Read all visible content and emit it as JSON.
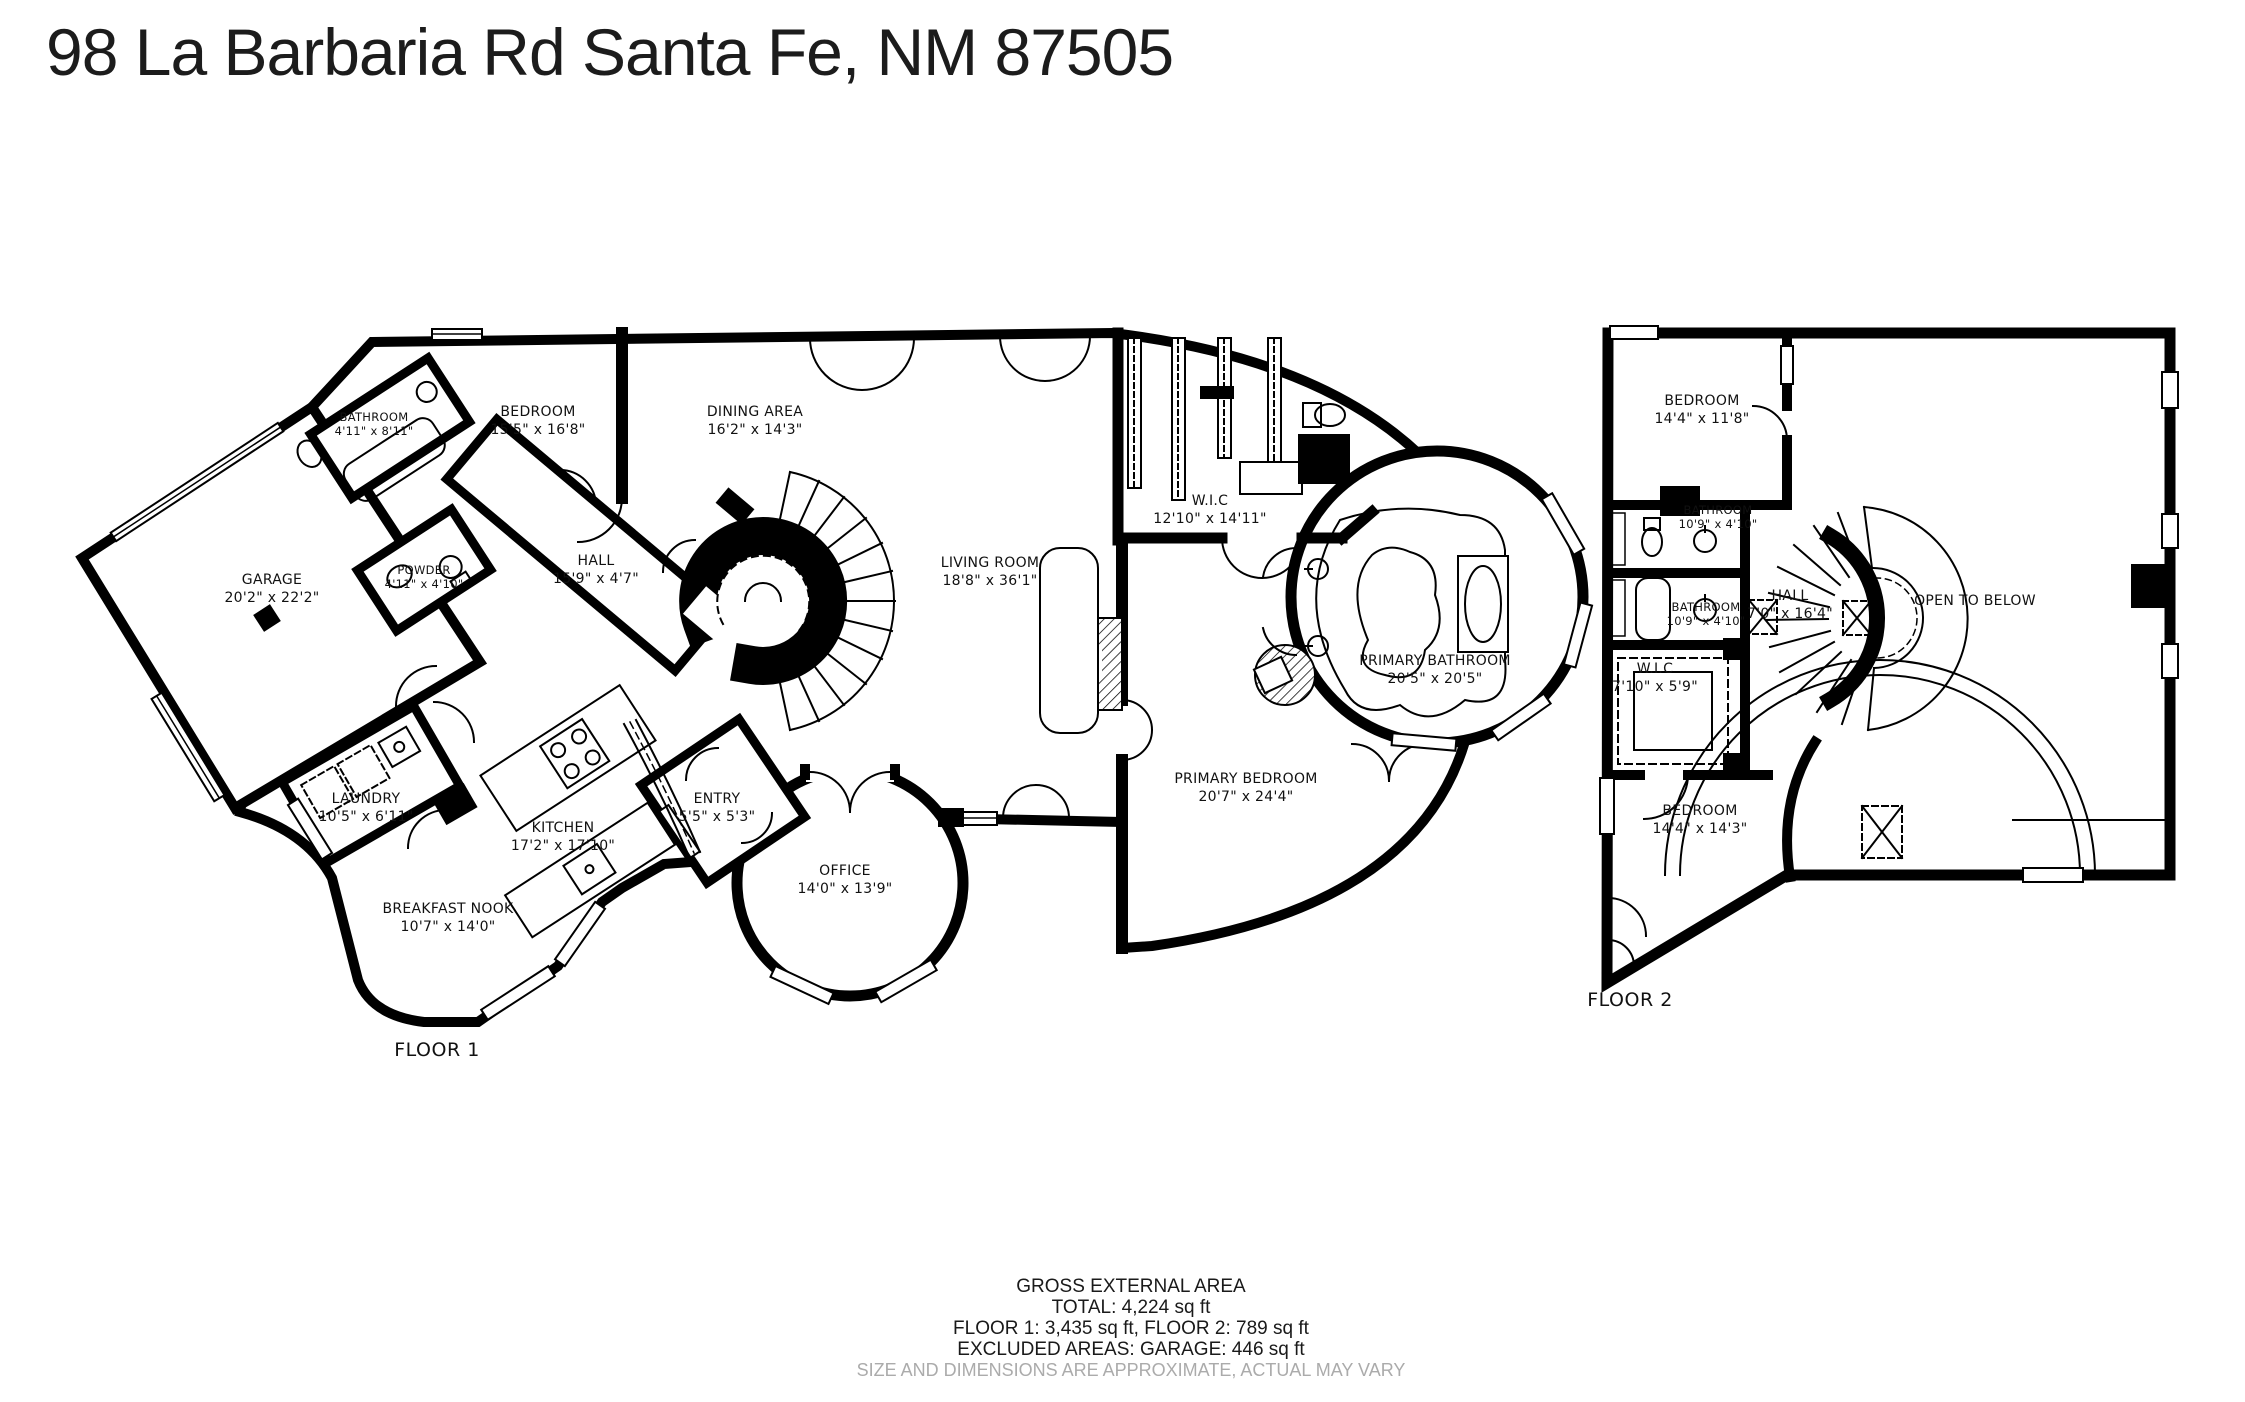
{
  "title": "98 La Barbaria Rd Santa Fe, NM 87505",
  "floor1": {
    "label": "FLOOR 1",
    "rooms": {
      "bathroom": {
        "name": "BATHROOM",
        "dims": "4'11\" x 8'11\""
      },
      "bedroom": {
        "name": "BEDROOM",
        "dims": "15'5\" x 16'8\""
      },
      "dining": {
        "name": "DINING AREA",
        "dims": "16'2\" x 14'3\""
      },
      "garage": {
        "name": "GARAGE",
        "dims": "20'2\" x 22'2\""
      },
      "powder": {
        "name": "POWDER",
        "dims": "4'11\" x 4'10\""
      },
      "hall": {
        "name": "HALL",
        "dims": "15'9\" x 4'7\""
      },
      "wic": {
        "name": "W.I.C",
        "dims": "12'10\" x 14'11\""
      },
      "living": {
        "name": "LIVING ROOM",
        "dims": "18'8\" x 36'1\""
      },
      "primary_bathroom": {
        "name": "PRIMARY BATHROOM",
        "dims": "20'5\" x 20'5\""
      },
      "primary_bedroom": {
        "name": "PRIMARY BEDROOM",
        "dims": "20'7\" x 24'4\""
      },
      "laundry": {
        "name": "LAUNDRY",
        "dims": "10'5\" x 6'11\""
      },
      "kitchen": {
        "name": "KITCHEN",
        "dims": "17'2\" x 17'10\""
      },
      "entry": {
        "name": "ENTRY",
        "dims": "5'5\" x 5'3\""
      },
      "office": {
        "name": "OFFICE",
        "dims": "14'0\" x 13'9\""
      },
      "breakfast": {
        "name": "BREAKFAST NOOK",
        "dims": "10'7\" x 14'0\""
      }
    }
  },
  "floor2": {
    "label": "FLOOR 2",
    "rooms": {
      "bedroom_top": {
        "name": "BEDROOM",
        "dims": "14'4\" x 11'8\""
      },
      "bathroom_upper": {
        "name": "BATHROOM",
        "dims": "10'9\" x 4'10\""
      },
      "bathroom_lower": {
        "name": "BATHROOM",
        "dims": "10'9\" x 4'10\""
      },
      "hall": {
        "name": "HALL",
        "dims": "7'0\" x 16'4\""
      },
      "open_to_below": {
        "name": "OPEN TO BELOW"
      },
      "wic": {
        "name": "W.I.C",
        "dims": "7'10\" x 5'9\""
      },
      "bedroom_bottom": {
        "name": "BEDROOM",
        "dims": "14'4\" x 14'3\""
      }
    }
  },
  "footer": {
    "line1": "GROSS EXTERNAL AREA",
    "line2": "TOTAL: 4,224 sq ft",
    "line3": "FLOOR 1: 3,435 sq ft, FLOOR 2: 789 sq ft",
    "line4": "EXCLUDED AREAS: GARAGE: 446 sq ft",
    "disclaimer": "SIZE AND DIMENSIONS ARE APPROXIMATE, ACTUAL MAY VARY"
  },
  "colors": {
    "wall": "#000000",
    "background": "#ffffff",
    "text": "#111111",
    "disclaimer_text": "#ababab"
  }
}
